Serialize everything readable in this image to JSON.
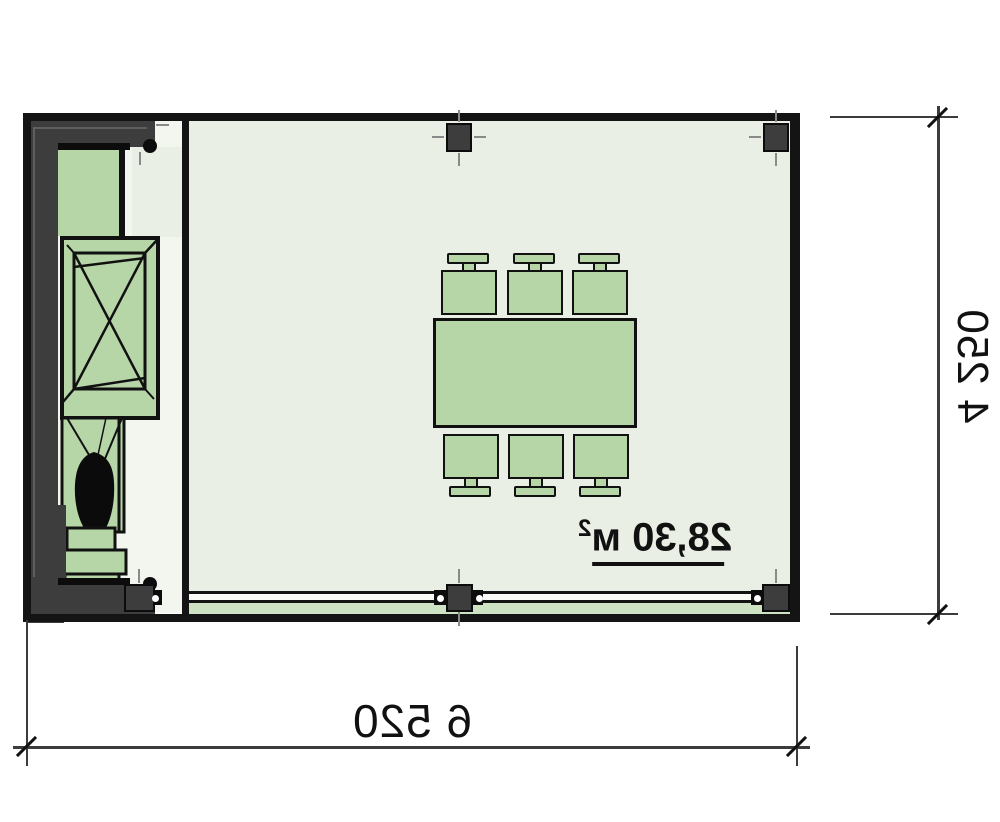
{
  "plan": {
    "type": "floor-plan-top-view",
    "area_text": "28,30 м",
    "area_superscript": "2",
    "width_dimension": "6 520",
    "depth_dimension": "4 250",
    "text_is_mirrored": true
  },
  "objects": {
    "dining_table": "dining-table-icon",
    "chairs": "chair-icon x6",
    "annex_counter": "counter-icon",
    "annex_crossed_box": "stove-crossed-box-icon",
    "annex_plant": "plant-silhouette-icon",
    "annex_steps": "pedestal-steps-icon",
    "columns": "structural-column-icon x2",
    "glazing_posts": "window-mullion-icon x3",
    "glass_wall": "glazed-wall",
    "dimension_ticks": "dimension-tick-icon"
  },
  "colors": {
    "furniture_green": "#b6d6a8",
    "room_fill": "#e9efe5",
    "annex_fill": "#f3f6ee",
    "wall_dark": "#3d3d3d",
    "wall_black": "#141414",
    "ink": "#111111",
    "sill_green": "#cde3c3",
    "glass_white": "#fafbf7",
    "line_gray": "#3c3c3c",
    "tick_gray": "#8a8a8a",
    "plant_black": "#0b0b0b"
  }
}
